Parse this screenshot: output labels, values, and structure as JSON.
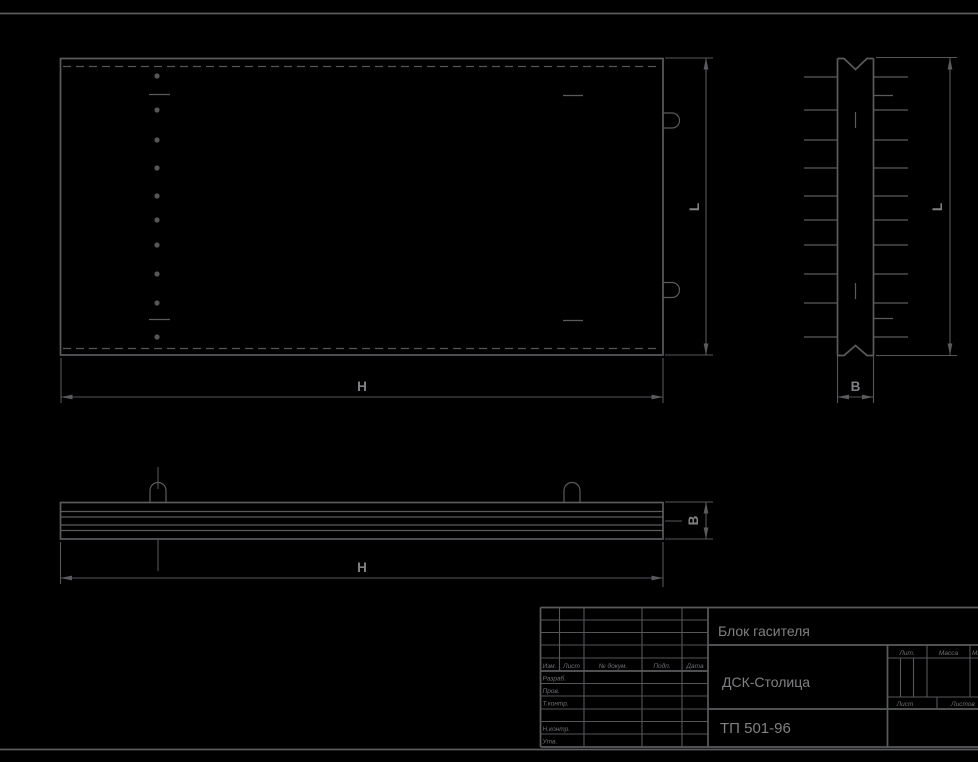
{
  "drawing": {
    "type": "engineering-drawing",
    "colors": {
      "background": "#000000",
      "line": "#5a5b5e",
      "text": "#7f8083"
    },
    "dimension_labels": {
      "plan_length": "H",
      "plan_height": "L",
      "side_height": "L",
      "side_width": "B",
      "bottom_length": "H",
      "bottom_thickness": "B"
    },
    "title_block": {
      "title": "Блок гасителя",
      "organization": "ДСК-Столица",
      "document_number": "ТП 501-96",
      "change_table_headers": {
        "izm": "Изм.",
        "list": "Лист",
        "doc": "№ докум.",
        "sign": "Подп.",
        "date": "Дата"
      },
      "signature_rows": {
        "developed": "Разраб.",
        "checked": "Пров.",
        "t_control": "Т.контр.",
        "n_control": "Н.контр.",
        "approved": "Утв."
      },
      "right_table": {
        "litera": "Лит.",
        "mass": "Масса",
        "scale": "Масштаб",
        "sheet": "Лист",
        "sheets": "Листов"
      }
    }
  }
}
